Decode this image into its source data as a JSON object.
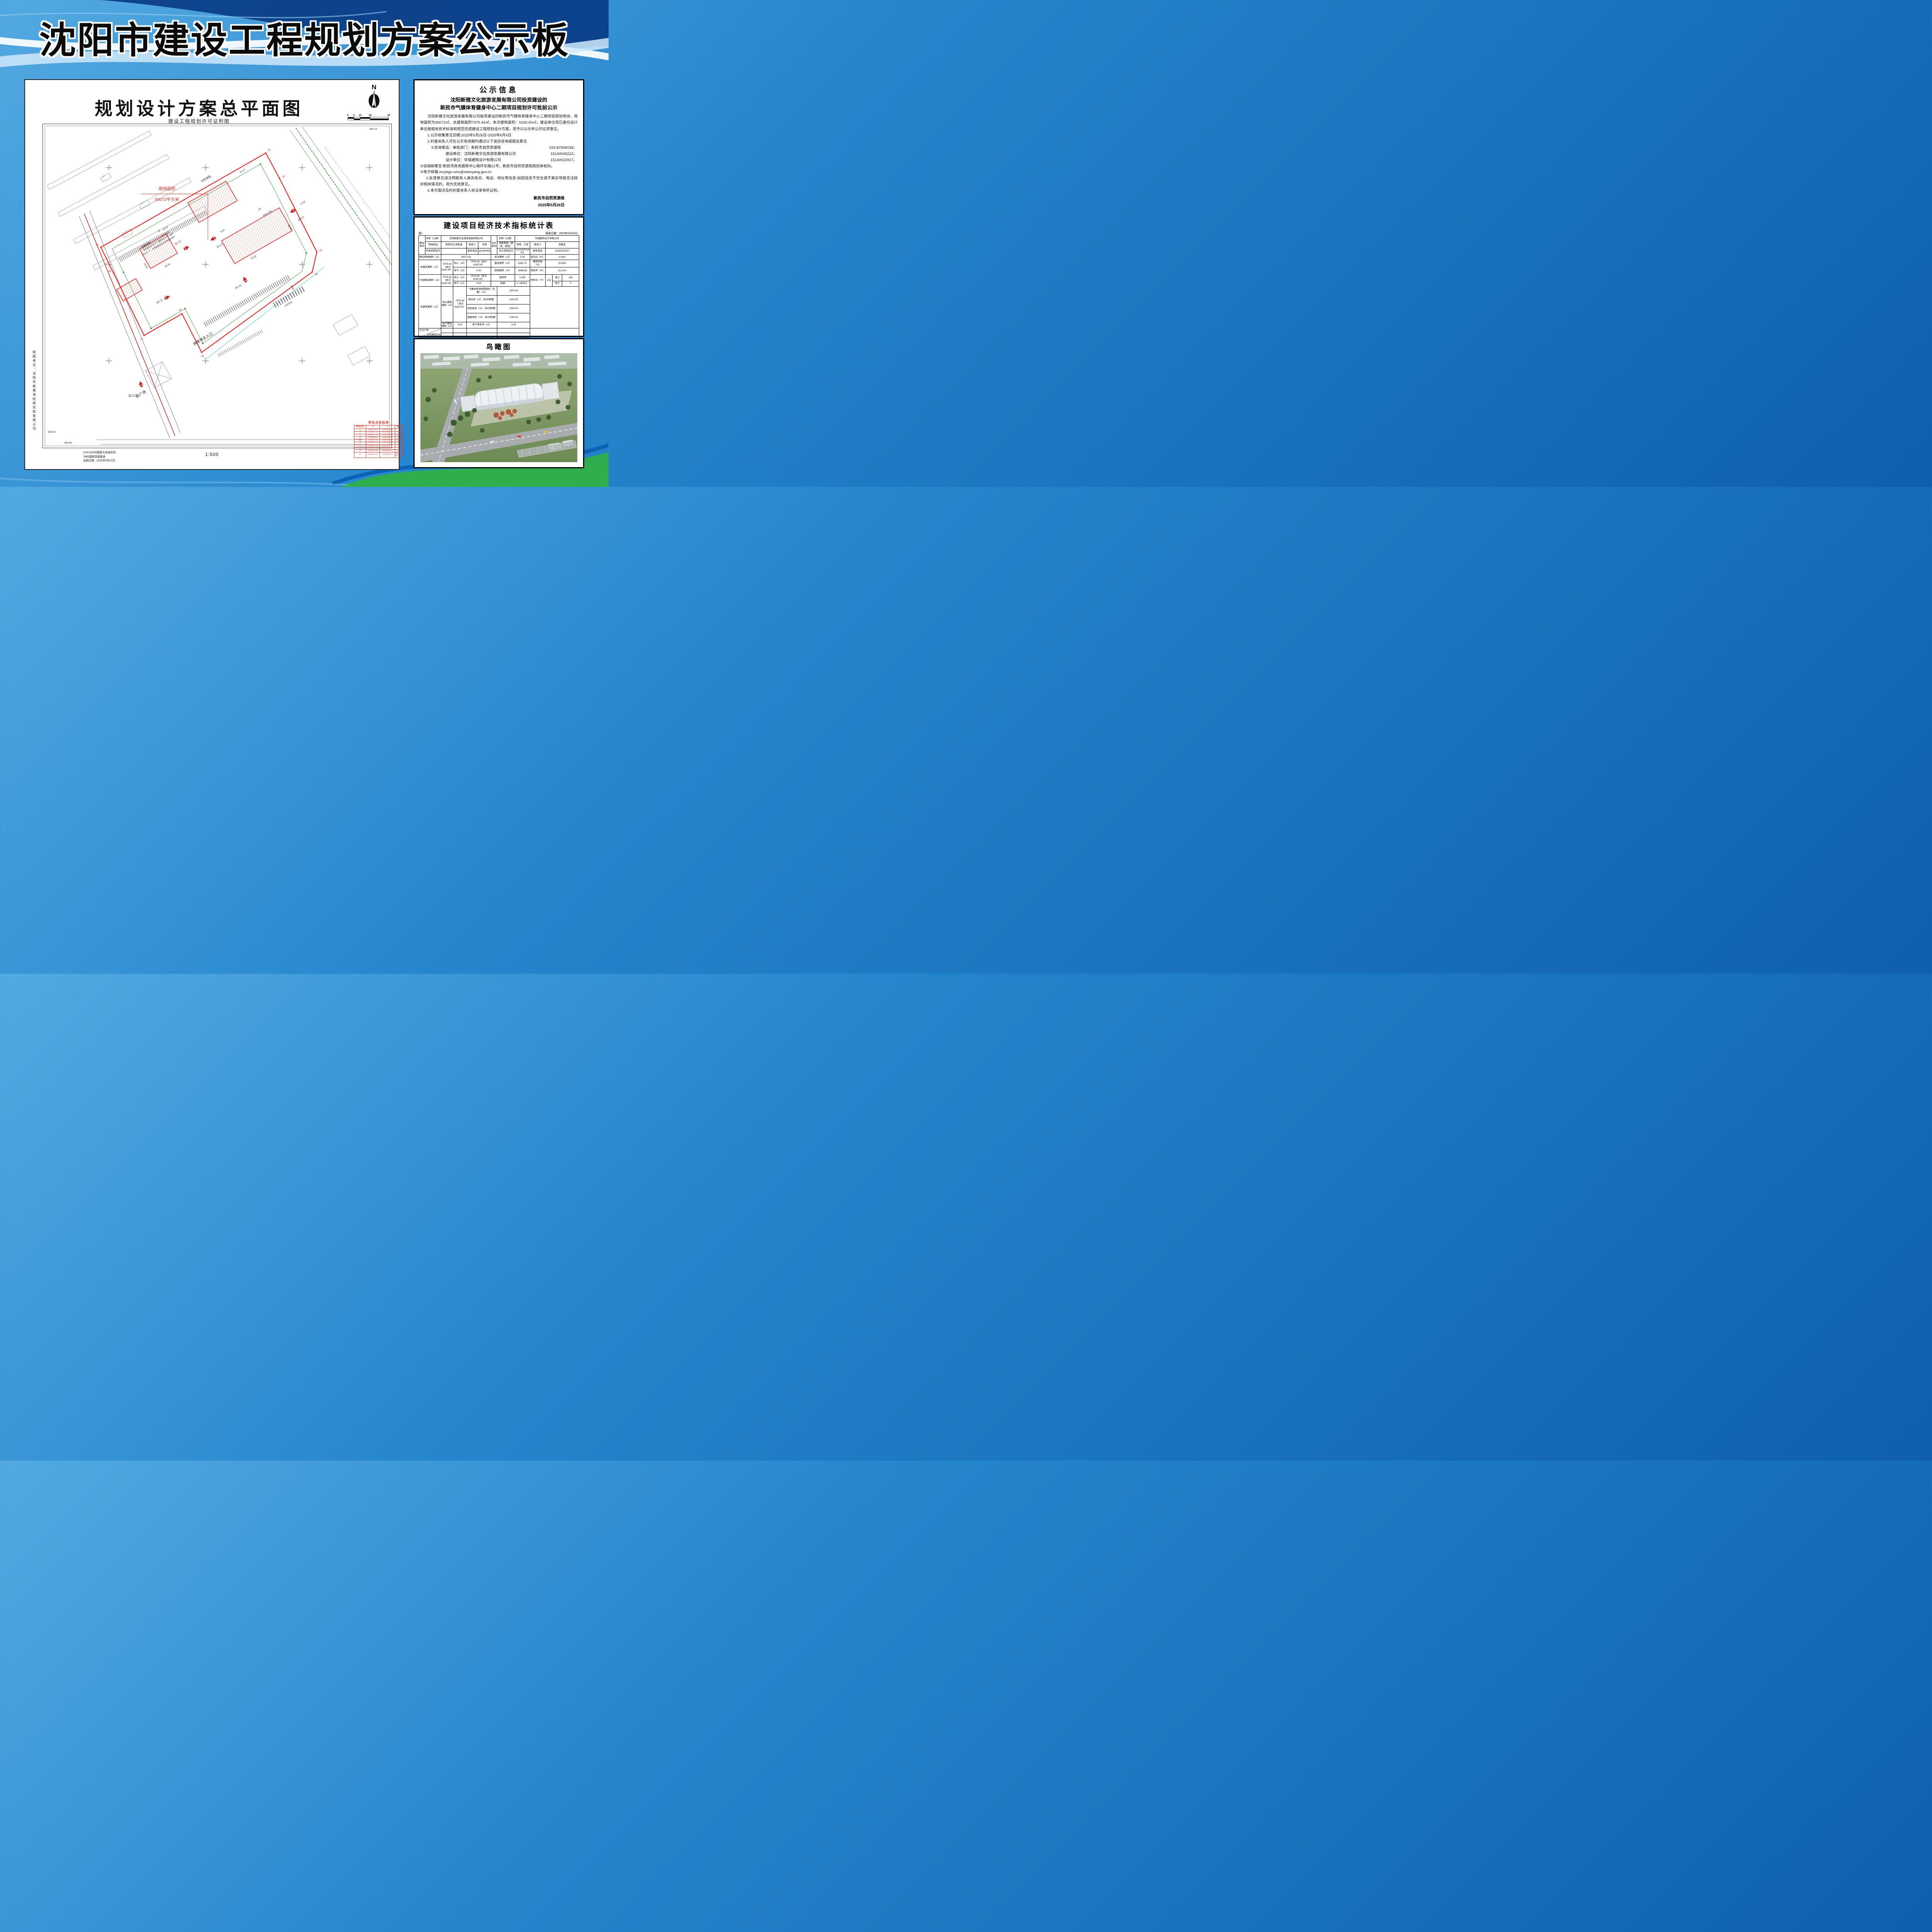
{
  "banner": {
    "title": "沈阳市建设工程规划方案公示板"
  },
  "plan": {
    "title": "规划设计方案总平面图",
    "subtitle": "建设工程规划许可证附图",
    "north": "N",
    "scalebar": [
      "0",
      "5",
      "10",
      "20",
      "30"
    ],
    "scale_text": "1:500",
    "area_note1": "用地面积",
    "area_note2": "30072平方米",
    "labels": {
      "floor1": "1F",
      "floor2": "2F",
      "h7": "H1=7.00",
      "h9": "H1=9.00",
      "badminton": "羽毛球馆",
      "support": "配套用房",
      "entrance": "出入口",
      "main_entrance": "体育场主入口",
      "plaza": "前广场",
      "bus": "大巴车位",
      "bike1": "非机动车位 54 个，面积 86.4 ㎡，其中",
      "bike2": "车位 27 个，并预留配套充电设施建设条件"
    },
    "dims": {
      "d1": "75.00",
      "d2": "30.00",
      "d3": "35.00",
      "d4": "25.00",
      "d5": "6.60",
      "d6": "12.05",
      "d7": "15.72",
      "d8": "23.30",
      "d9": "6.53"
    },
    "corners": {
      "bl1": "648.54",
      "bl2": "485.86",
      "tr": "486.19"
    },
    "notes": [
      "CGCS2000国家大地坐标系",
      "1985国家高程基准",
      "出图日期：2025年5月22日"
    ],
    "credit": "制图单位：沈阳市勘察测绘研究院有限公司",
    "jpoints": [
      "J1",
      "J2",
      "J3",
      "J4",
      "J5",
      "J6",
      "J7",
      "J8",
      "J9"
    ],
    "jtable": {
      "title": "界址点坐标表",
      "headers": [
        "界址点号",
        "X",
        "Y",
        "距离"
      ],
      "points": [
        {
          "id": "J1",
          "x": "4648825.67",
          "y": "41486072.35"
        },
        {
          "id": "J2",
          "x": "4648797.77",
          "y": "41486087.43"
        },
        {
          "id": "J3",
          "x": "4648717.30",
          "y": "41486130.94"
        },
        {
          "id": "J4",
          "x": "4648695.61",
          "y": "41486125.71"
        },
        {
          "id": "J5",
          "x": "4648607.72",
          "y": "41485997.96"
        },
        {
          "id": "J6",
          "x": "4648650.20",
          "y": "41485975.00"
        },
        {
          "id": "J7",
          "x": "4648626.53",
          "y": "41485931.22"
        },
        {
          "id": "J8",
          "x": "4648694.28",
          "y": "41485896.00"
        },
        {
          "id": "J9",
          "x": "4648722.45",
          "y": "41485881.41"
        },
        {
          "id": "J1",
          "x": "4648825.67",
          "y": "41486072.35"
        }
      ],
      "distances": [
        "31.71",
        "91.48",
        "22.31",
        "155.06",
        "48.29",
        "49.77",
        "76.36",
        "31.72",
        "217.05"
      ]
    }
  },
  "notice": {
    "title": "公示信息",
    "heading1": "沈阳新雅文化旅游发展有限公司投资建设的",
    "heading2": "新民市气膜体育健身中心二期项目规划许可批前公示",
    "paragraph": "沈阳新雅文化旅游发展有限公司投资建设的新民市气膜体育健身中心二期项目规划地块，用地面积为30072㎡，总建筑面积7975.44㎡，本次建筑面积：6100.00㎡，建设单位现已委托设计单位按相关技术标准和规范完成建设工程规划设计方案，现予以公示并公开征求意见。",
    "item1": "1.公示收集意见日期:2025年5月26日-2025年6月4日",
    "item2": "2.利害关系人可在公示有效期内通过以下途径咨询或提出意见",
    "tel_rows": [
      {
        "label": "①咨询电话：审批部门：新民市自然资源局",
        "phone": "024-87506038；"
      },
      {
        "label": "建设单位：沈阳新雅文化旅游发展有限公司",
        "phone": "15140049222；"
      },
      {
        "label": "设计单位：华域建筑设计有限公司",
        "phone": "15140022917。"
      }
    ],
    "item_mail_to": "②信函邮寄至:新民市政务服务中心南环东路21号，新民市自然资源局规划审批科。",
    "item_email": "③电子邮箱:zrzybgs-xms@shenyang.gov.cn",
    "item3": "3.反馈意见请注明联系人真实姓名、电话、地址等信息;如因信息不完全或不真实导致无法核对相关情况的，视为无效意见。",
    "item4": "4.本方案涉及的利害关系人依法享有听证权。",
    "signer": "新民市自然资源局",
    "sign_date": "2025年5月26日"
  },
  "ind": {
    "title": "建设项目经济技术指标统计表",
    "table_tag": "表1",
    "fill_date": "填表日期：2025年4月30日",
    "unit_label": "建设单位",
    "design_unit_label": "设计单位",
    "name_label": "名称（公章）",
    "builder_name": "沈阳新雅文化旅游发展有限公司",
    "designer_name": "华域建筑设计有限公司",
    "addr_label": "项目地址",
    "addr": "新民市辽滨街道",
    "contact_label": "联系人",
    "builder_contact": "王刚",
    "qual_label": "资质等级（建筑、规划）",
    "qual": "甲级、乙级",
    "designer_contact": "陆春生",
    "dev_cert_label": "开发资质证号",
    "dev_cert": "",
    "tel_label": "联系电话",
    "builder_tel": "15140049222",
    "design_cert_label": "设计资质证号",
    "design_cert": "A121005316-6/1",
    "designer_tel": "15140022917",
    "land_label": "建设用地面积（㎡）",
    "land": "30072.00",
    "comm_label": "商业面积（㎡）",
    "comm": "0.00",
    "comm_ratio_label": "商业比（%）",
    "comm_ratio": "0.00%",
    "total_label": "总建设面积（㎡）",
    "total_val": "7975.44（本次6100.00）",
    "above_label": "地上（㎡）",
    "above_val": "7975.44（本次6100.00）",
    "base_label": "基底面积（㎡）",
    "base": "6162.72",
    "density_label": "建筑密度（%）",
    "density": "20.49%",
    "below_label": "地下（㎡）",
    "below_val": "0.00",
    "green_label": "绿地面积（㎡）",
    "green": "4546.89",
    "green_ratio_label": "绿地率（%）",
    "green_ratio": "15.12%",
    "far_area_label": "计容建设面积（㎡）",
    "far_label": "容积率",
    "far": "0.265",
    "parking_label": "停车位（个）",
    "parking_total": "152",
    "parking_above_label": "地上",
    "parking_above": "152",
    "blocks_label": "栋数",
    "blocks": "4（本次3）",
    "parking_below_label": "地下",
    "parking_below": "0",
    "gfa_label": "总建筑面积（㎡）",
    "gfa_above_label": "地上建筑面积（㎡）",
    "gfa_above_val": "7975.44（本次6100.00）",
    "item1_label": "气膜体育场附属用房（已建）（㎡）",
    "item1": "1875.44",
    "item2_label": "游泳馆（㎡）（本次新建）",
    "item2": "2100.00",
    "item3_label": "羽毛球馆（㎡）（本次新建）",
    "item3": "2250.00",
    "item4_label": "配套用房（㎡）（本次新建）",
    "item4": "1750.00",
    "gfa_below_label": "地下建筑面积（㎡）",
    "gfa_below": "0.00",
    "upark_label": "地下停车场（㎡）",
    "upark": "0.00",
    "resi_label1": "住宅户数",
    "resi_label2": "住宅建筑区间",
    "resi_park_label": "配建停车位（个）"
  },
  "bird": {
    "title": "鸟瞰图"
  }
}
